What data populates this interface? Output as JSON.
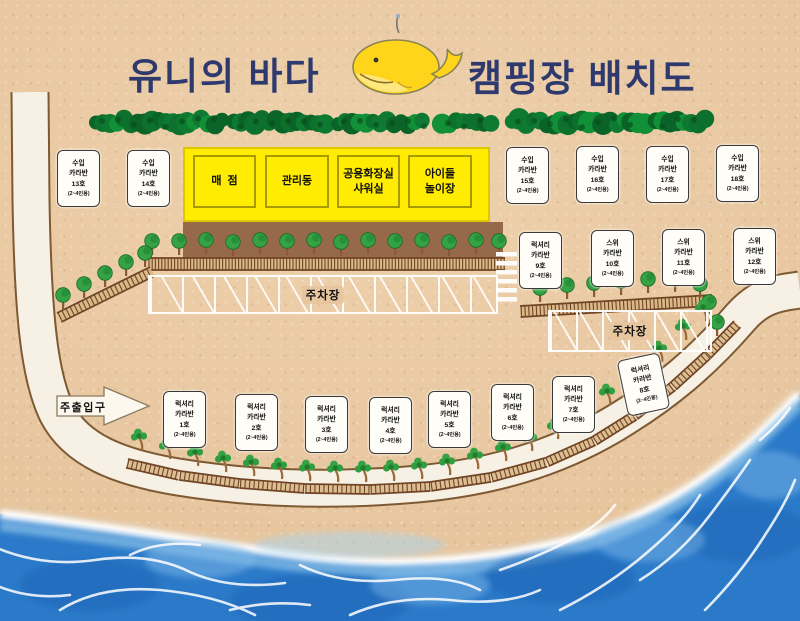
{
  "title": {
    "left": "유니의 바다",
    "right": "캠핑장 배치도"
  },
  "entrance_label": "주출입구",
  "parking_label": "주차장",
  "buildings": [
    {
      "lines": [
        "매  점",
        ""
      ]
    },
    {
      "lines": [
        "관리동",
        ""
      ]
    },
    {
      "lines": [
        "공용화장실",
        "샤워실"
      ]
    },
    {
      "lines": [
        "아이들",
        "놀이장"
      ]
    }
  ],
  "caravans": [
    {
      "type": "수입",
      "name": "카라반",
      "number": "13호",
      "capacity": "(2~4인용)"
    },
    {
      "type": "수입",
      "name": "카라반",
      "number": "14호",
      "capacity": "(2~4인용)"
    },
    {
      "type": "수입",
      "name": "카라반",
      "number": "15호",
      "capacity": "(2~4인용)"
    },
    {
      "type": "수입",
      "name": "카라반",
      "number": "16호",
      "capacity": "(2~4인용)"
    },
    {
      "type": "수입",
      "name": "카라반",
      "number": "17호",
      "capacity": "(2~4인용)"
    },
    {
      "type": "수입",
      "name": "카라반",
      "number": "18호",
      "capacity": "(2~4인용)"
    },
    {
      "type": "럭셔리",
      "name": "카라반",
      "number": "9호",
      "capacity": "(2~4인용)"
    },
    {
      "type": "스위",
      "name": "카라반",
      "number": "10호",
      "capacity": "(2~4인용)"
    },
    {
      "type": "스위",
      "name": "카라반",
      "number": "11호",
      "capacity": "(2~4인용)"
    },
    {
      "type": "스위",
      "name": "카라반",
      "number": "12호",
      "capacity": "(2~4인용)"
    },
    {
      "type": "럭셔리",
      "name": "카라반",
      "number": "1호",
      "capacity": "(2~4인용)"
    },
    {
      "type": "럭셔리",
      "name": "카라반",
      "number": "2호",
      "capacity": "(2~4인용)"
    },
    {
      "type": "럭셔리",
      "name": "카라반",
      "number": "3호",
      "capacity": "(2~4인용)"
    },
    {
      "type": "럭셔리",
      "name": "카라반",
      "number": "4호",
      "capacity": "(2~4인용)"
    },
    {
      "type": "럭셔리",
      "name": "카라반",
      "number": "5호",
      "capacity": "(2~4인용)"
    },
    {
      "type": "럭셔리",
      "name": "카라반",
      "number": "6호",
      "capacity": "(2~4인용)"
    },
    {
      "type": "럭셔리",
      "name": "카라반",
      "number": "7호",
      "capacity": "(2~4인용)"
    },
    {
      "type": "럭셔리",
      "name": "카라반",
      "number": "8호",
      "capacity": "(2~4인용)"
    }
  ],
  "colors": {
    "sand": "#e6c49c",
    "water": "#2b7ac9",
    "hedge_green": "#0e7a31",
    "building_yellow": "#ffec00",
    "title_navy": "#2e3a6e"
  }
}
